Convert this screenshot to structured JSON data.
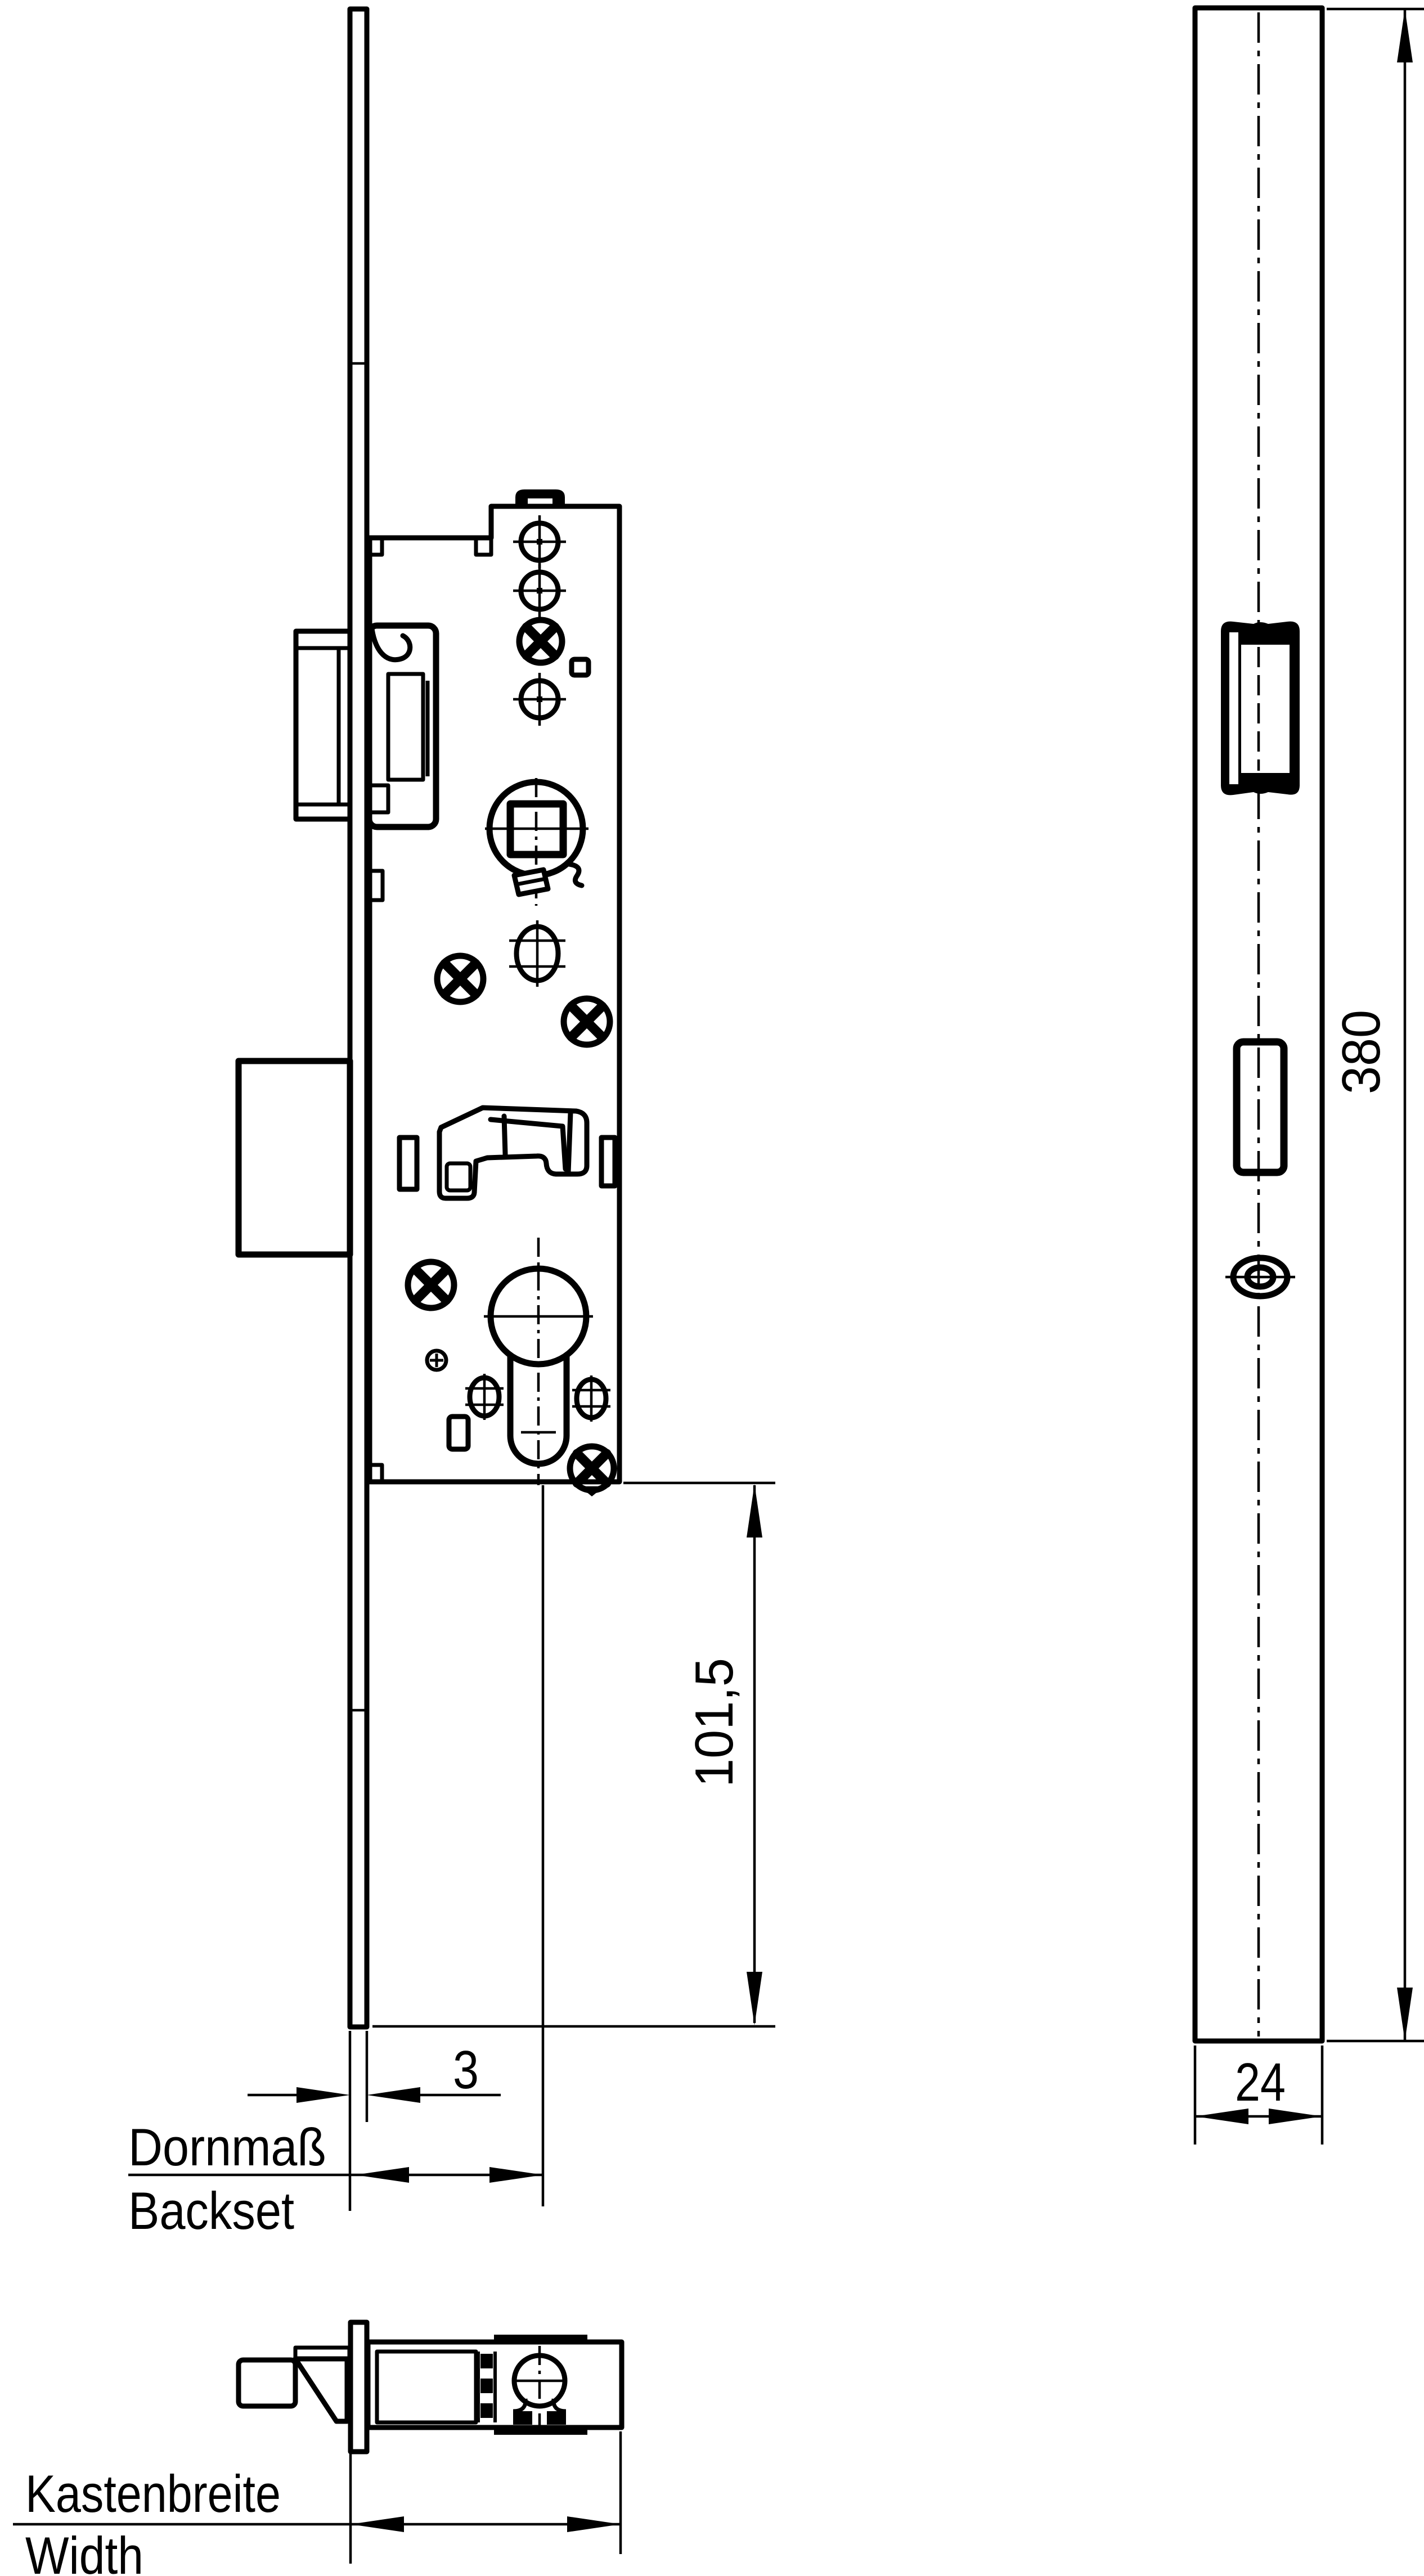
{
  "drawing": {
    "kind": "lock-technical-drawing",
    "colors": {
      "ink": "#000000",
      "paper": "#ffffff"
    },
    "labels": {
      "backset_de": "Dornmaß",
      "backset_en": "Backset",
      "case_width_de": "Kastenbreite",
      "case_width_en": "Width"
    },
    "dimensions": {
      "faceplate_thickness_mm": "3",
      "case_to_plate_end_mm": "101,5",
      "faceplate_length_mm": "380",
      "faceplate_width_mm": "24"
    }
  }
}
